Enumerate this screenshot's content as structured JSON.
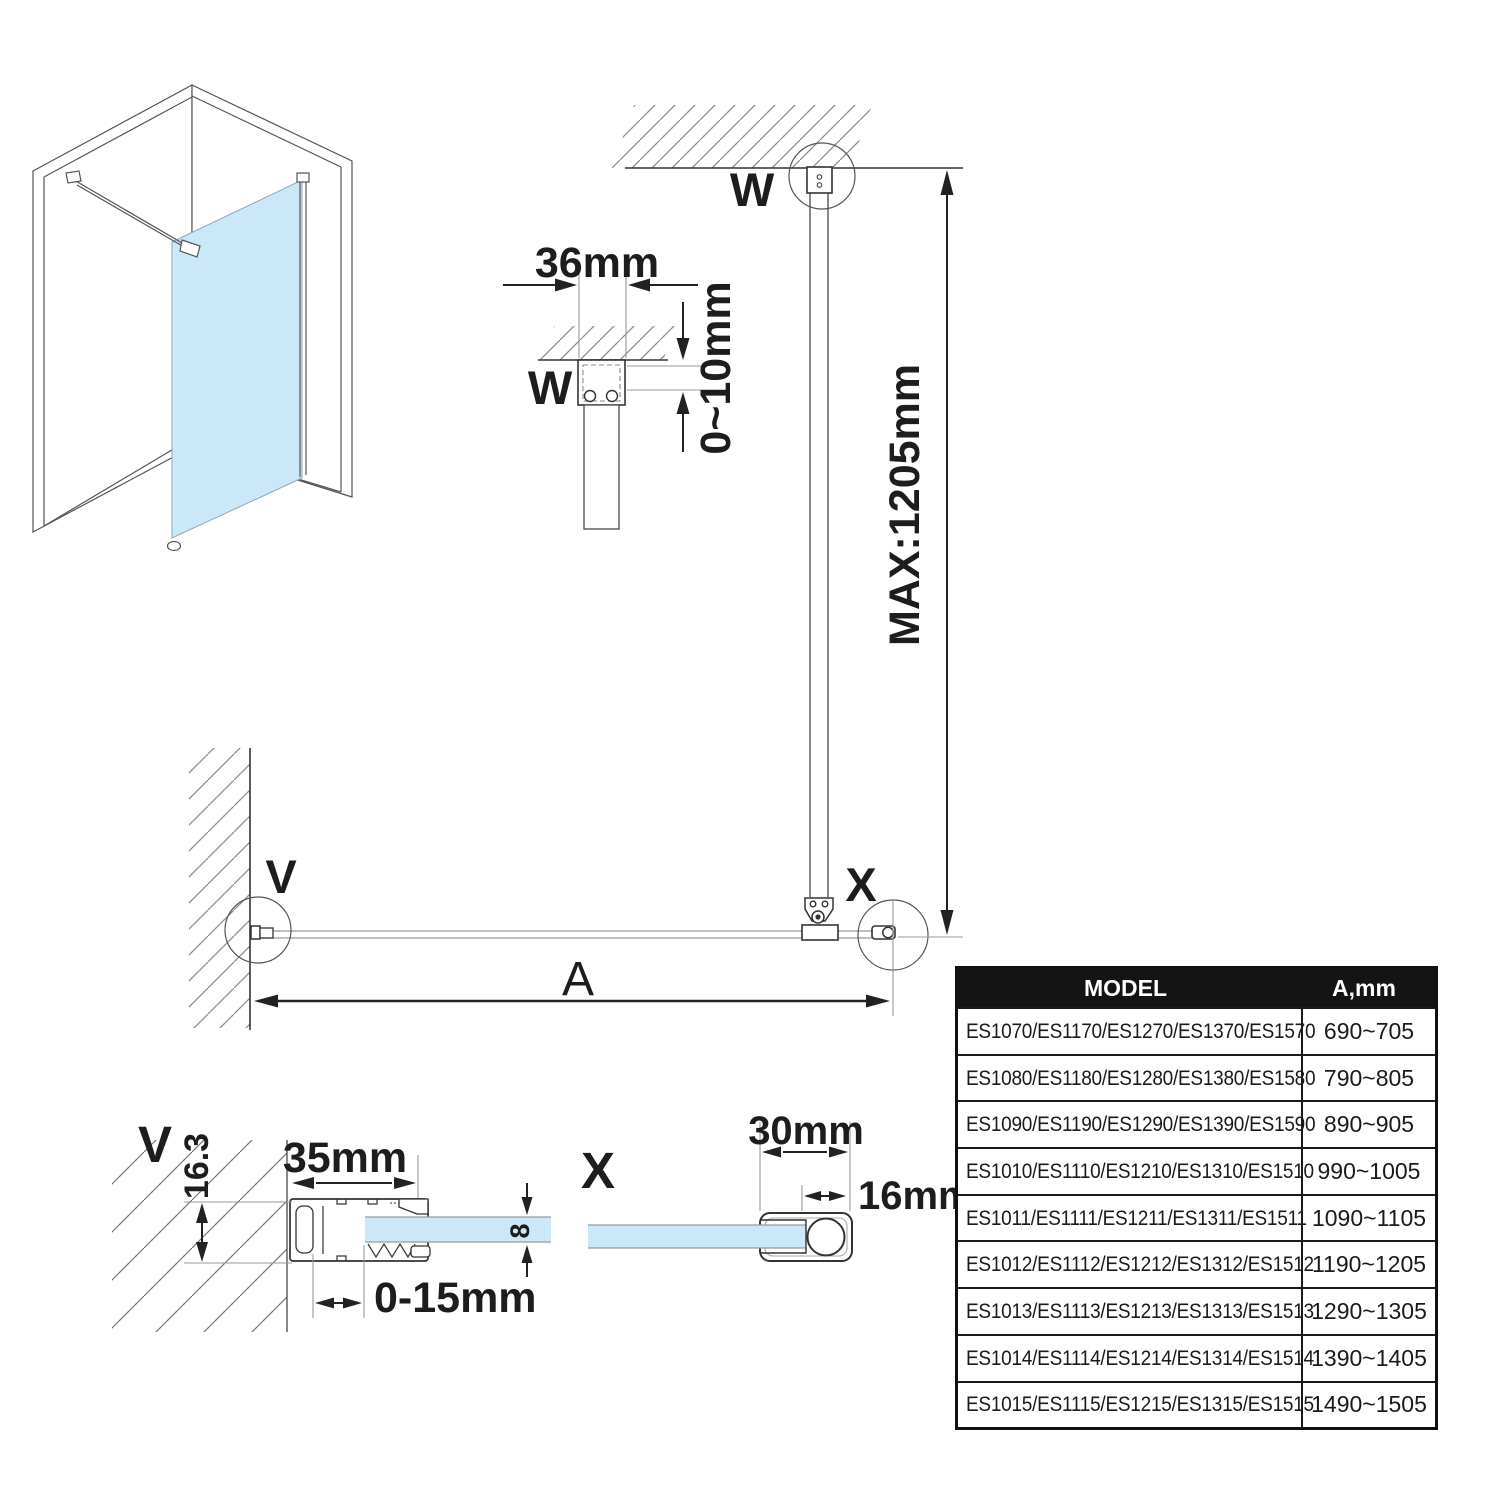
{
  "colors": {
    "glass": "#cbe8f9",
    "glass_edge": "#9aa7ad",
    "line_dark": "#222222",
    "line_mid": "#555555",
    "ext_line": "#999999",
    "table_header_bg": "#141414",
    "table_header_text": "#ffffff"
  },
  "plan": {
    "label_w": "W",
    "label_v": "V",
    "label_x": "X",
    "dim_a": "A",
    "dim_max": "MAX:1205mm"
  },
  "detail_w": {
    "label": "W",
    "dim_width": "36mm",
    "dim_gap": "0~10mm"
  },
  "detail_v": {
    "label": "V",
    "dim_width": "35mm",
    "dim_depth": "16.3",
    "dim_adjust": "0-15mm",
    "dim_glass_thickness": "8"
  },
  "detail_x": {
    "label": "X",
    "dim_width": "30mm",
    "dim_bar": "16mm"
  },
  "table": {
    "headers": [
      "MODEL",
      "A,mm"
    ],
    "rows": [
      {
        "model": "ES1070/ES1170/ES1270/ES1370/ES1570",
        "a": "690~705"
      },
      {
        "model": "ES1080/ES1180/ES1280/ES1380/ES1580",
        "a": "790~805"
      },
      {
        "model": "ES1090/ES1190/ES1290/ES1390/ES1590",
        "a": "890~905"
      },
      {
        "model": "ES1010/ES1110/ES1210/ES1310/ES1510",
        "a": "990~1005"
      },
      {
        "model": "ES1011/ES1111/ES1211/ES1311/ES1511",
        "a": "1090~1105"
      },
      {
        "model": "ES1012/ES1112/ES1212/ES1312/ES1512",
        "a": "1190~1205"
      },
      {
        "model": "ES1013/ES1113/ES1213/ES1313/ES1513",
        "a": "1290~1305"
      },
      {
        "model": "ES1014/ES1114/ES1214/ES1314/ES1514",
        "a": "1390~1405"
      },
      {
        "model": "ES1015/ES1115/ES1215/ES1315/ES1515",
        "a": "1490~1505"
      }
    ]
  }
}
